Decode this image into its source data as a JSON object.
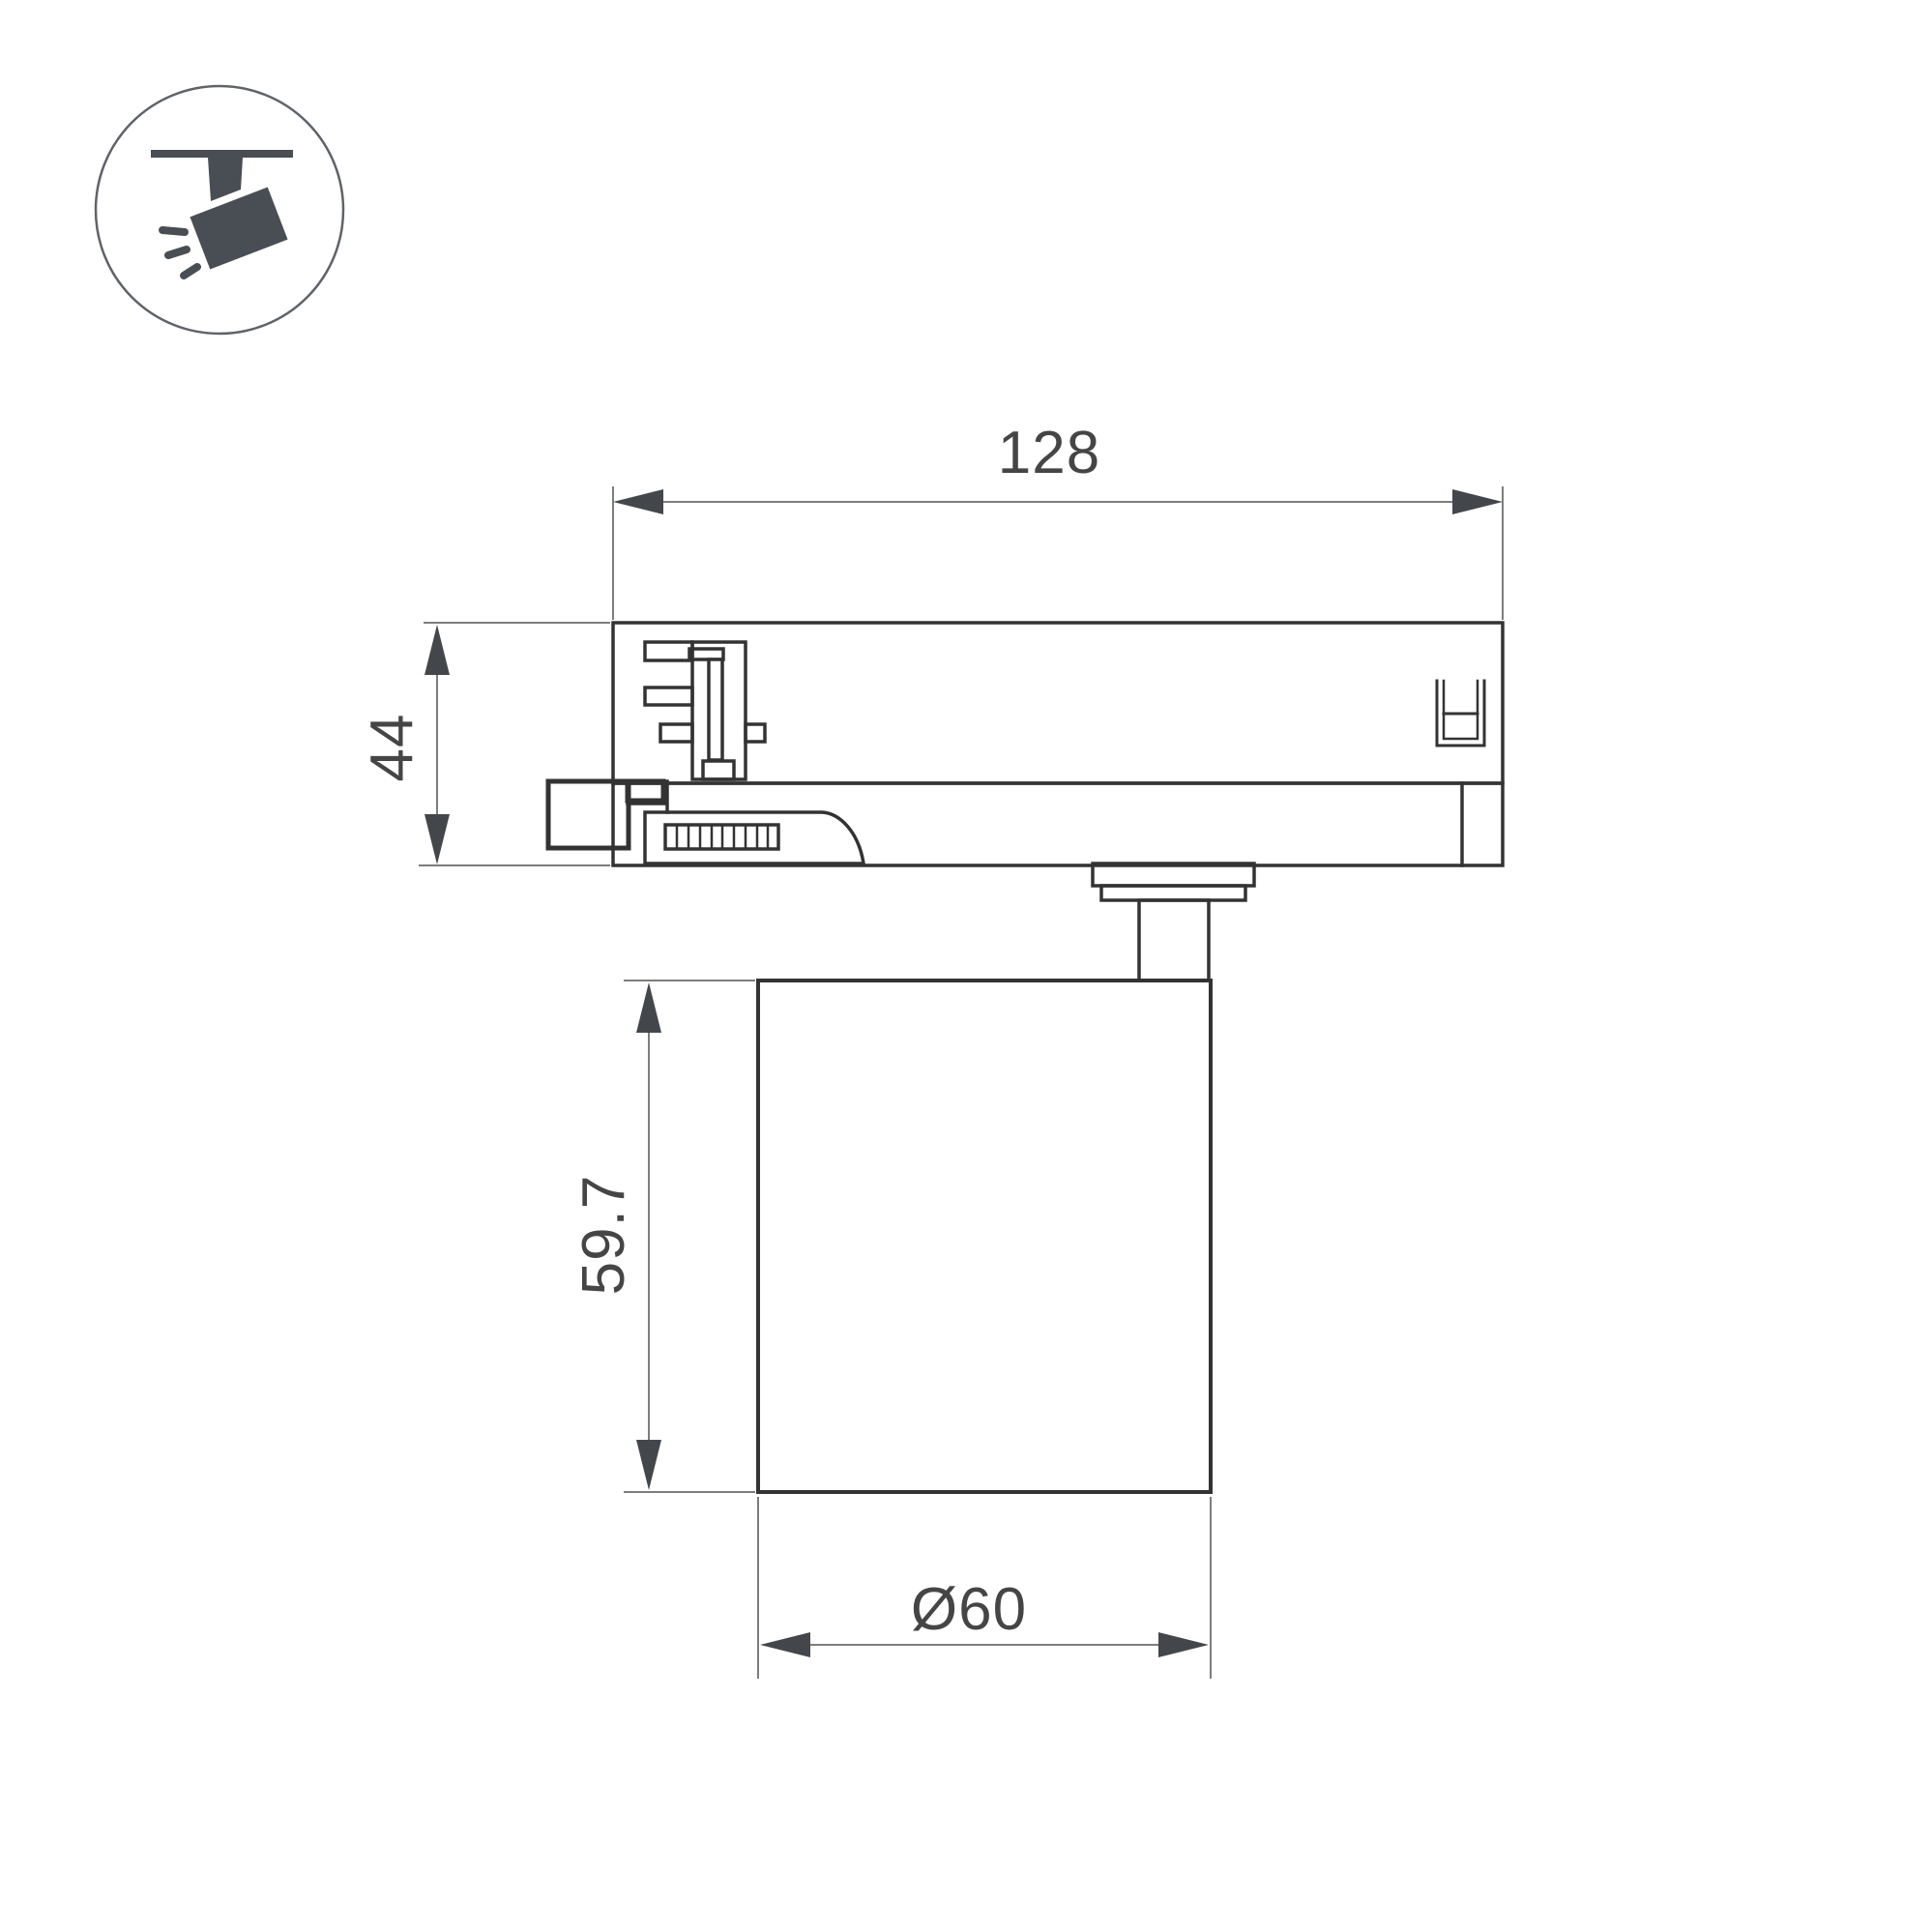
{
  "icon": {
    "name": "track-spotlight-icon",
    "color": "#494e54",
    "circle_stroke": "#5f6368"
  },
  "drawing": {
    "line_color": "#333333",
    "dim_line_color": "#7d7d7d",
    "arrow_color": "#43474b",
    "text_color": "#454545",
    "dims": {
      "track_width": "128",
      "adapter_height": "44",
      "body_height": "59.7",
      "body_diameter": "Ø60"
    }
  }
}
